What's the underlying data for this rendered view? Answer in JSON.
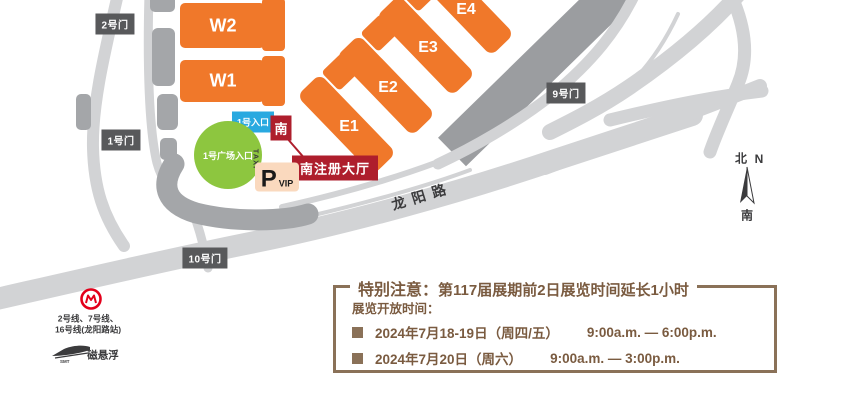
{
  "halls": {
    "w2": "W2",
    "w1": "W1",
    "e1": "E1",
    "e2": "E2",
    "e3": "E3",
    "e4": "E4"
  },
  "gates": {
    "gate2": "2号门",
    "gate1": "1号门",
    "gate10": "10号门",
    "gate9": "9号门"
  },
  "entrances": {
    "entrance1": "1号入口",
    "plaza": "1号广场入口",
    "south_badge": "南",
    "south_hall": "南注册大厅"
  },
  "road": {
    "name": "龙阳路"
  },
  "parking": {
    "p": "P",
    "vip": "VIP",
    "taxi": "TAXI"
  },
  "compass": {
    "north_cn": "北",
    "north_en": "N",
    "south_cn": "南"
  },
  "transit": {
    "metro_line_1": "2号线、7号线、",
    "metro_line_2": "16号线(龙阳路站)",
    "maglev_label": "磁悬浮",
    "maglev_sub": "SMT"
  },
  "notice": {
    "title_label": "特别注意：",
    "title_text": "第117届展期前2日展览时间延长1小时",
    "subtitle": "展览开放时间：",
    "rows": [
      {
        "date": "2024年7月18-19日（周四/五）",
        "time": "9:00a.m. — 6:00p.m."
      },
      {
        "date": "2024年7月20日（周六）",
        "time": "9:00a.m. — 3:00p.m."
      }
    ]
  },
  "colors": {
    "hall_orange": "#F0782A",
    "gate_gray": "#58595B",
    "entrance_cyan": "#29A9E0",
    "south_red": "#AE1E2C",
    "plaza_green": "#8DC63F",
    "road_gray": "#D2D3D5",
    "dark_gray": "#A4A6A9",
    "median_gray": "#9B9DA0",
    "notice_brown": "#8A7158",
    "metro_red": "#E3001B",
    "parking_peach": "#FAD9BE"
  }
}
